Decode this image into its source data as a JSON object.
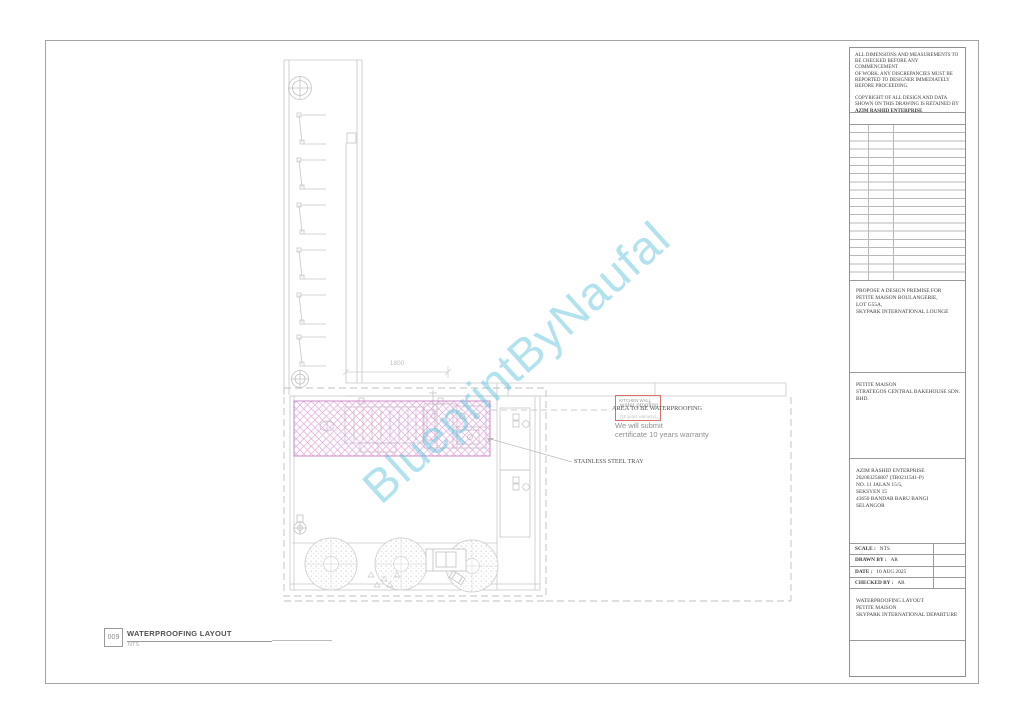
{
  "watermark": "BlueprintByNaufal",
  "plan": {
    "dimension_label": "1800",
    "kitchen_wall_box": {
      "line1": "KITCHEN WALL",
      "line2": "water proofing",
      "line3": "(10 years warranty)"
    },
    "area_label": "AREA TO BE WATERPROOFING",
    "warranty_note": "We will submit\ncertificate 10 years warranty",
    "tray_label": "STAINLESS STEEL TRAY",
    "hatch_color": "#c97fc3",
    "annotation_red": "#dd7168",
    "watermark_color": "#63c6dd"
  },
  "drawing_label": {
    "number": "009",
    "title": "WATERPROOFING LAYOUT",
    "scale": "NTS"
  },
  "titleblock": {
    "notes": "ALL DIMENSIONS AND MEASUREMENTS TO\nBE CHECKED BEFORE ANY COMMENCEMENT\nOF WORK. ANY DISCREPANCIES MUST BE\nREPORTED TO DESIGNER IMMEDIATELY\nBEFORE PROCEEDING.",
    "copyright": "COPYRIGHT OF ALL DESIGN AND DATA\nSHOWN ON THIS DRAWING IS RETAINED BY",
    "copyright_company": "AZIM RASHID ENTERPRISE",
    "project": "PROPOSE A DESIGN PREMISE FOR\nPETITE MAISON BOULANGERIE,\nLOT G55A,\nSKYPARK INTERNATIONAL LOUNGE",
    "client": "PETITE MAISON\nSTRATEGOS CENTRAL BAKEHOUSE SDN. BHD.",
    "company": "AZIM RASHID ENTERPRISE\n202003256807 (TR0211541-P)\nNO. 11 JALAN 15/5,\nSEKSYEN 15\n43650 BANDAR BARU BANGI\nSELANGOR",
    "fields": [
      {
        "label": "SCALE :",
        "value": "NTS"
      },
      {
        "label": "DRAWN BY :",
        "value": "AR"
      },
      {
        "label": "DATE :",
        "value": "10 AUG 2025"
      },
      {
        "label": "CHECKED BY :",
        "value": "AR"
      }
    ],
    "sheet_title": "WATERPROOFING LAYOUT\nPETITE MAISON\nSKYPARK INTERNATIONAL DEPARTURE"
  }
}
